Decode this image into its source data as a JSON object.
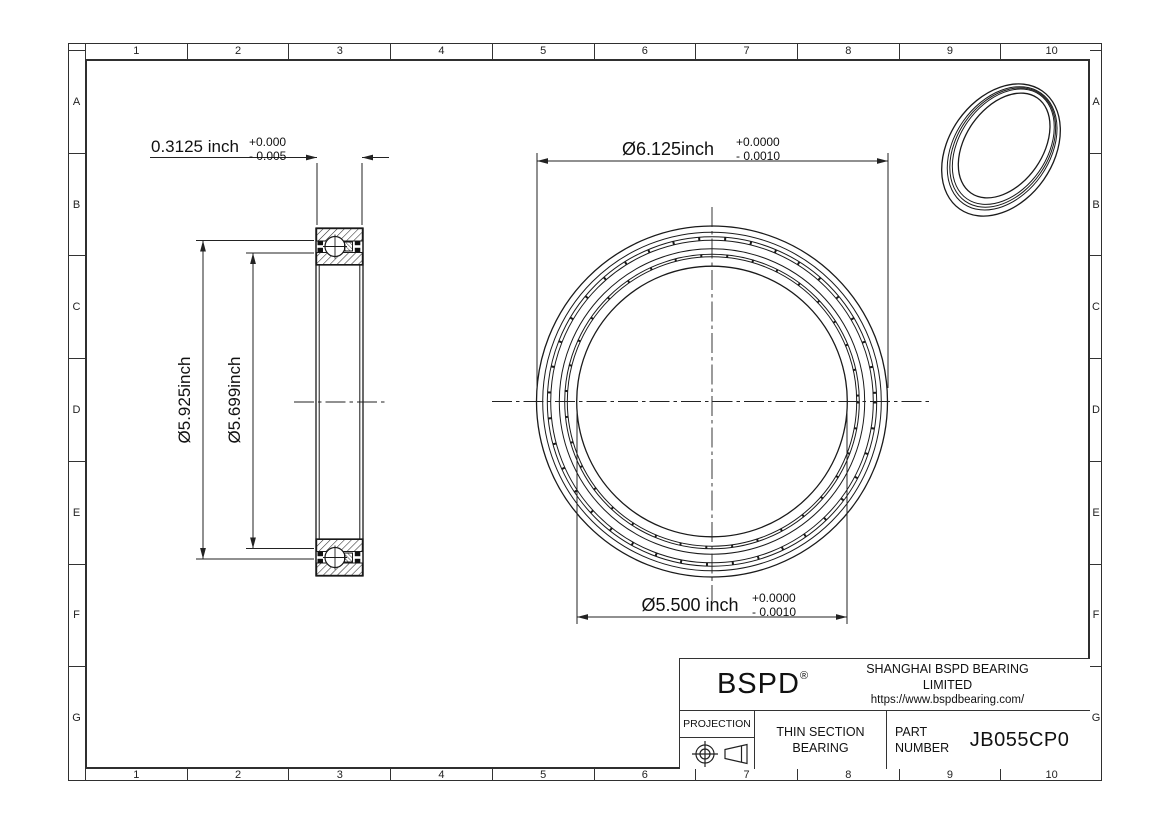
{
  "frame": {
    "columns": [
      "1",
      "2",
      "3",
      "4",
      "5",
      "6",
      "7",
      "8",
      "9",
      "10"
    ],
    "rows": [
      "A",
      "B",
      "C",
      "D",
      "E",
      "F",
      "G"
    ]
  },
  "dimensions": {
    "width": {
      "value": "0.3125 inch",
      "tol_plus": "+0.000",
      "tol_minus": "- 0.005"
    },
    "outer_diameter": {
      "value": "Ø6.125inch",
      "tol_plus": "+0.0000",
      "tol_minus": "- 0.0010"
    },
    "bore_diameter": {
      "value": "Ø5.500 inch",
      "tol_plus": "+0.0000",
      "tol_minus": "- 0.0010"
    },
    "outer_race_diameter": {
      "value": "Ø5.925inch"
    },
    "inner_race_diameter": {
      "value": "Ø5.699inch"
    }
  },
  "title_block": {
    "logo": "BSPD",
    "registered_mark": "®",
    "company": "SHANGHAI BSPD BEARING LIMITED",
    "website": "https://www.bspdbearing.com/",
    "projection_label": "PROJECTION",
    "product_type_line1": "THIN SECTION",
    "product_type_line2": "BEARING",
    "part_number_label_line1": "PART",
    "part_number_label_line2": "NUMBER",
    "part_number": "JB055CP0"
  },
  "colors": {
    "line": "#1a1a1a",
    "dim": "#222222",
    "background": "#ffffff"
  }
}
